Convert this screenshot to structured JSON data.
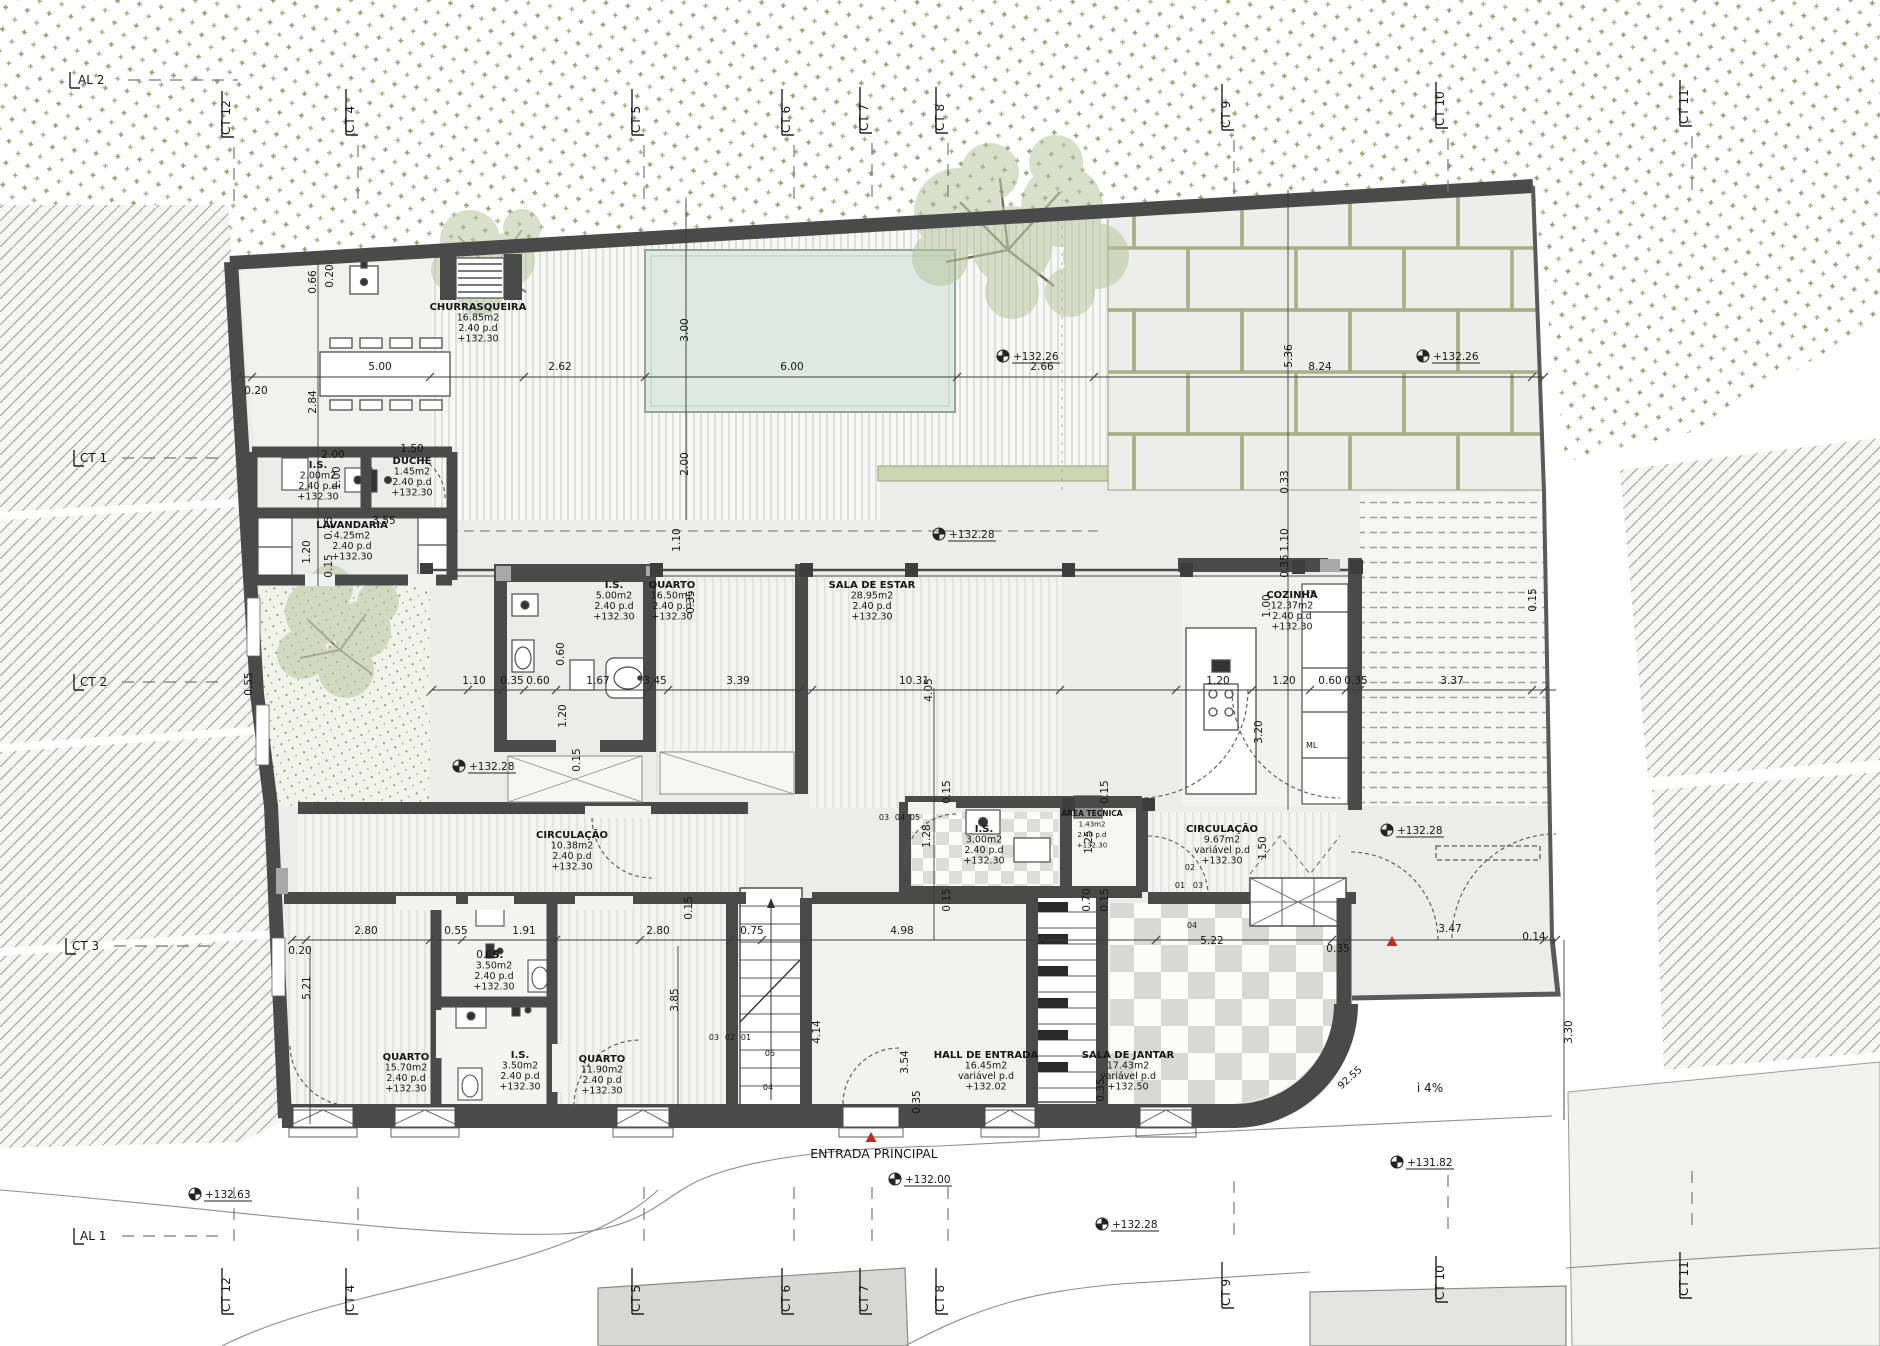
{
  "drawing": {
    "type": "architectural-floor-plan",
    "entrance_note": "ENTRADA  PRINCIPAL",
    "slope_note": "i  4%",
    "radius_note": "92.55",
    "plot_edge_dim": "3.30",
    "fridge_tag": "FR",
    "appliance_tag": "ML"
  },
  "colors": {
    "wall": "#4a4a4a",
    "pool": "#dfe9e4",
    "vegetation": "#96996b",
    "paver_joint": "#a9ae86",
    "red_marker": "#b4301f",
    "hatch": "#a6a6a6"
  },
  "room_labels": [
    {
      "name": "CHURRASQUEIRA",
      "area": "16.85m2",
      "pd": "2.40  p.d",
      "level": "+132.30",
      "x": 478,
      "y": 310
    },
    {
      "name": "I.S.",
      "area": "2.00m2",
      "pd": "2.40  p.d",
      "level": "+132.30",
      "x": 318,
      "y": 468
    },
    {
      "name": "DUCHE",
      "area": "1.45m2",
      "pd": "2.40  p.d",
      "level": "+132.30",
      "x": 412,
      "y": 464
    },
    {
      "name": "LAVANDARIA",
      "area": "4.25m2",
      "pd": "2.40  p.d",
      "level": "+132.30",
      "x": 352,
      "y": 528
    },
    {
      "name": "I.S.",
      "area": "5.00m2",
      "pd": "2.40  p.d",
      "level": "+132.30",
      "x": 614,
      "y": 588
    },
    {
      "name": "QUARTO",
      "area": "16.50m2",
      "pd": "2.40  p.d",
      "level": "+132.30",
      "x": 672,
      "y": 588
    },
    {
      "name": "SALA DE ESTAR",
      "area": "28.95m2",
      "pd": "2.40  p.d",
      "level": "+132.30",
      "x": 872,
      "y": 588
    },
    {
      "name": "COZINHA",
      "area": "12.37m2",
      "pd": "2.40  p.d",
      "level": "+132.30",
      "x": 1292,
      "y": 598
    },
    {
      "name": "CIRCULAÇÃO",
      "area": "10.38m2",
      "pd": "2.40  p.d",
      "level": "+132.30",
      "x": 572,
      "y": 838
    },
    {
      "name": "I.S.",
      "area": "3.00m2",
      "pd": "2.40  p.d",
      "level": "+132.30",
      "x": 984,
      "y": 832
    },
    {
      "name": "AREA TECNICA",
      "area": "1.43m2",
      "pd": "2.40  p.d",
      "level": "+132.30",
      "x": 1092,
      "y": 816,
      "small": true
    },
    {
      "name": "CIRCULAÇÃO",
      "area": "9.67m2",
      "pd": "variável  p.d",
      "level": "+132.30",
      "x": 1222,
      "y": 832
    },
    {
      "name": "QUARTO",
      "area": "15.70m2",
      "pd": "2.40  p.d",
      "level": "+132.30",
      "x": 406,
      "y": 1060
    },
    {
      "name": "I.S.",
      "area": "3.50m2",
      "pd": "2.40  p.d",
      "level": "+132.30",
      "x": 494,
      "y": 958
    },
    {
      "name": "I.S.",
      "area": "3.50m2",
      "pd": "2.40  p.d",
      "level": "+132.30",
      "x": 520,
      "y": 1058
    },
    {
      "name": "QUARTO",
      "area": "11.90m2",
      "pd": "2.40  p.d",
      "level": "+132.30",
      "x": 602,
      "y": 1062
    },
    {
      "name": "HALL DE ENTRADA",
      "area": "16.45m2",
      "pd": "variável  p.d",
      "level": "+132.02",
      "x": 986,
      "y": 1058
    },
    {
      "name": "SALA DE JANTAR",
      "area": "17.43m2",
      "pd": "variável  p.d",
      "level": "+132.50",
      "x": 1128,
      "y": 1058
    }
  ],
  "level_markers": [
    {
      "t": "+132.26",
      "x": 1016,
      "y": 360
    },
    {
      "t": "+132.26",
      "x": 1436,
      "y": 360
    },
    {
      "t": "+132.28",
      "x": 952,
      "y": 538
    },
    {
      "t": "+132.28",
      "x": 472,
      "y": 770
    },
    {
      "t": "+132.28",
      "x": 1400,
      "y": 834
    },
    {
      "t": "+132.63",
      "x": 208,
      "y": 1198
    },
    {
      "t": "+132.00",
      "x": 908,
      "y": 1183
    },
    {
      "t": "+132.28",
      "x": 1115,
      "y": 1228
    },
    {
      "t": "+131.82",
      "x": 1410,
      "y": 1166
    }
  ],
  "red_markers": [
    {
      "x": 871,
      "y": 1138
    },
    {
      "x": 1392,
      "y": 942
    }
  ],
  "dims_h": [
    {
      "t": "0.20",
      "x": 256,
      "y": 394
    },
    {
      "t": "5.00",
      "x": 380,
      "y": 370
    },
    {
      "t": "2.62",
      "x": 560,
      "y": 370
    },
    {
      "t": "6.00",
      "x": 792,
      "y": 370
    },
    {
      "t": "2.66",
      "x": 1042,
      "y": 370
    },
    {
      "t": "8.24",
      "x": 1320,
      "y": 370
    },
    {
      "t": "2.00",
      "x": 333,
      "y": 458
    },
    {
      "t": "1.50",
      "x": 412,
      "y": 452
    },
    {
      "t": "3.55",
      "x": 384,
      "y": 524
    },
    {
      "t": "1.10",
      "x": 474,
      "y": 684
    },
    {
      "t": "0.35",
      "x": 512,
      "y": 684
    },
    {
      "t": "0.60",
      "x": 538,
      "y": 684
    },
    {
      "t": "1.67",
      "x": 598,
      "y": 684
    },
    {
      "t": "3.45",
      "x": 655,
      "y": 684
    },
    {
      "t": "3.39",
      "x": 738,
      "y": 684
    },
    {
      "t": "10.31",
      "x": 914,
      "y": 684
    },
    {
      "t": "1.20",
      "x": 1218,
      "y": 684
    },
    {
      "t": "1.20",
      "x": 1284,
      "y": 684
    },
    {
      "t": "0.60",
      "x": 1330,
      "y": 684
    },
    {
      "t": "0.35",
      "x": 1356,
      "y": 684
    },
    {
      "t": "3.37",
      "x": 1452,
      "y": 684
    },
    {
      "t": "0.20",
      "x": 300,
      "y": 954
    },
    {
      "t": "2.80",
      "x": 366,
      "y": 934
    },
    {
      "t": "0.55",
      "x": 456,
      "y": 934
    },
    {
      "t": "1.91",
      "x": 524,
      "y": 934
    },
    {
      "t": "0.15",
      "x": 488,
      "y": 958
    },
    {
      "t": "2.80",
      "x": 658,
      "y": 934
    },
    {
      "t": "0.75",
      "x": 752,
      "y": 934
    },
    {
      "t": "4.98",
      "x": 902,
      "y": 934
    },
    {
      "t": "5.22",
      "x": 1212,
      "y": 944
    },
    {
      "t": "0.35",
      "x": 1338,
      "y": 952
    },
    {
      "t": "3.47",
      "x": 1450,
      "y": 932
    },
    {
      "t": "0.14",
      "x": 1534,
      "y": 940
    }
  ],
  "dims_v": [
    {
      "t": "0.66",
      "x": 316,
      "y": 282
    },
    {
      "t": "0.20",
      "x": 333,
      "y": 276
    },
    {
      "t": "2.84",
      "x": 316,
      "y": 402
    },
    {
      "t": "3.00",
      "x": 688,
      "y": 330
    },
    {
      "t": "2.00",
      "x": 688,
      "y": 464
    },
    {
      "t": "1.10",
      "x": 680,
      "y": 540
    },
    {
      "t": "0.35",
      "x": 694,
      "y": 602
    },
    {
      "t": "5.36",
      "x": 1292,
      "y": 356
    },
    {
      "t": "0.33",
      "x": 1288,
      "y": 482
    },
    {
      "t": "1.10",
      "x": 1288,
      "y": 540
    },
    {
      "t": "0.35",
      "x": 1288,
      "y": 566
    },
    {
      "t": "1.00",
      "x": 1270,
      "y": 606
    },
    {
      "t": "3.20",
      "x": 1262,
      "y": 732
    },
    {
      "t": "1.20",
      "x": 310,
      "y": 552
    },
    {
      "t": "0.15",
      "x": 332,
      "y": 528
    },
    {
      "t": "0.15",
      "x": 332,
      "y": 566
    },
    {
      "t": "1.00",
      "x": 340,
      "y": 478
    },
    {
      "t": "0.55",
      "x": 252,
      "y": 684
    },
    {
      "t": "0.60",
      "x": 564,
      "y": 654
    },
    {
      "t": "1.20",
      "x": 566,
      "y": 716
    },
    {
      "t": "0.15",
      "x": 580,
      "y": 760
    },
    {
      "t": "4.05",
      "x": 932,
      "y": 690
    },
    {
      "t": "0.15",
      "x": 1536,
      "y": 600
    },
    {
      "t": "5.21",
      "x": 310,
      "y": 988
    },
    {
      "t": "3.85",
      "x": 678,
      "y": 1000
    },
    {
      "t": "4.14",
      "x": 820,
      "y": 1032
    },
    {
      "t": "3.54",
      "x": 908,
      "y": 1062
    },
    {
      "t": "0.35",
      "x": 920,
      "y": 1102
    },
    {
      "t": "1.28",
      "x": 930,
      "y": 836
    },
    {
      "t": "1.25",
      "x": 1092,
      "y": 842
    },
    {
      "t": "0.70",
      "x": 1090,
      "y": 900
    },
    {
      "t": "0.15",
      "x": 950,
      "y": 792
    },
    {
      "t": "0.15",
      "x": 1108,
      "y": 792
    },
    {
      "t": "0.15",
      "x": 950,
      "y": 900
    },
    {
      "t": "0.15",
      "x": 1108,
      "y": 900
    },
    {
      "t": "1.50",
      "x": 1266,
      "y": 848
    },
    {
      "t": "3.30",
      "x": 1572,
      "y": 1032
    },
    {
      "t": "0.15",
      "x": 692,
      "y": 908
    },
    {
      "t": "0.35",
      "x": 1104,
      "y": 1090
    }
  ],
  "notes": [
    {
      "t": "ENTRADA  PRINCIPAL",
      "x": 874,
      "y": 1158,
      "size": 12.5
    },
    {
      "t": "i  4%",
      "x": 1430,
      "y": 1092,
      "size": 12
    },
    {
      "t": "92.55",
      "x": 1352,
      "y": 1080,
      "rot": -42,
      "size": 10
    },
    {
      "t": "FR",
      "x": 1306,
      "y": 596,
      "size": 8,
      "anchor": "start"
    },
    {
      "t": "ML",
      "x": 1306,
      "y": 748,
      "size": 8,
      "anchor": "start"
    }
  ],
  "stair_numbers": [
    {
      "t": "02",
      "x": 1190,
      "y": 870
    },
    {
      "t": "01",
      "x": 1180,
      "y": 888
    },
    {
      "t": "03",
      "x": 1198,
      "y": 888
    },
    {
      "t": "04",
      "x": 1192,
      "y": 928
    },
    {
      "t": "05",
      "x": 770,
      "y": 1056
    },
    {
      "t": "04",
      "x": 768,
      "y": 1090
    },
    {
      "t": "03",
      "x": 714,
      "y": 1040
    },
    {
      "t": "02",
      "x": 730,
      "y": 1040
    },
    {
      "t": "01",
      "x": 746,
      "y": 1040
    },
    {
      "t": "03",
      "x": 884,
      "y": 820
    },
    {
      "t": "04",
      "x": 900,
      "y": 820
    },
    {
      "t": "05",
      "x": 915,
      "y": 820
    }
  ],
  "grid_top": [
    {
      "t": "AL 2",
      "x": 78,
      "y": 84,
      "rot": 0
    },
    {
      "t": "CT 12",
      "x": 230,
      "y": 135,
      "rot": -90
    },
    {
      "t": "CT 4",
      "x": 354,
      "y": 133,
      "rot": -90
    },
    {
      "t": "CT 5",
      "x": 640,
      "y": 133,
      "rot": -90
    },
    {
      "t": "CT 6",
      "x": 790,
      "y": 133,
      "rot": -90
    },
    {
      "t": "CT 7",
      "x": 868,
      "y": 131,
      "rot": -90
    },
    {
      "t": "CT 8",
      "x": 944,
      "y": 131,
      "rot": -90
    },
    {
      "t": "CT 9",
      "x": 1230,
      "y": 128,
      "rot": -90
    },
    {
      "t": "CT 10",
      "x": 1444,
      "y": 126,
      "rot": -90
    },
    {
      "t": "CT 11",
      "x": 1688,
      "y": 124,
      "rot": -90
    }
  ],
  "grid_left": [
    {
      "t": "CT 1",
      "x": 80,
      "y": 462
    },
    {
      "t": "CT 2",
      "x": 80,
      "y": 686
    },
    {
      "t": "CT 3",
      "x": 72,
      "y": 950
    },
    {
      "t": "AL 1",
      "x": 80,
      "y": 1240
    }
  ],
  "grid_bottom": [
    {
      "t": "CT 12",
      "x": 230,
      "y": 1312,
      "rot": -90
    },
    {
      "t": "CT 4",
      "x": 354,
      "y": 1312,
      "rot": -90
    },
    {
      "t": "CT 5",
      "x": 640,
      "y": 1312,
      "rot": -90
    },
    {
      "t": "CT 6",
      "x": 790,
      "y": 1312,
      "rot": -90
    },
    {
      "t": "CT 7",
      "x": 868,
      "y": 1312,
      "rot": -90
    },
    {
      "t": "CT 8",
      "x": 944,
      "y": 1312,
      "rot": -90
    },
    {
      "t": "CT 9",
      "x": 1230,
      "y": 1306,
      "rot": -90
    },
    {
      "t": "CT 10",
      "x": 1444,
      "y": 1300,
      "rot": -90
    },
    {
      "t": "CT 11",
      "x": 1688,
      "y": 1296,
      "rot": -90
    }
  ]
}
